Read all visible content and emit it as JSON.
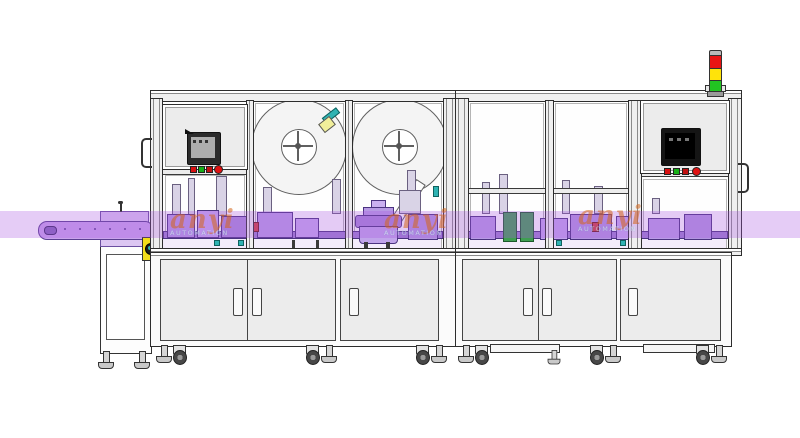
{
  "scene": {
    "description": "CAD line drawing of an automated assembly and labeling machine line with two framed enclosures, left infeed conveyor, two label reels, two HMI panels and a signal tower",
    "background": "#ffffff"
  },
  "colors": {
    "highlight_band": "#a855e0",
    "machinery_purple": "#b296e0",
    "conveyor_purple": "#c9a4ec",
    "frame_line": "#2d2d2d",
    "cabinet_panel": "#ececec",
    "drive_guard_yellow": "#f2dd1b",
    "accent_teal": "#2fb3b3",
    "accent_green": "#3f9e52"
  },
  "tower_light": {
    "segments": [
      {
        "state": "red",
        "color": "#e81414"
      },
      {
        "state": "yellow",
        "color": "#ffe30a"
      },
      {
        "state": "green",
        "color": "#22c422"
      }
    ]
  },
  "hmi_left": {
    "screen": "grey-lcd",
    "buttons": [
      "#d81111",
      "#17b017",
      "#c01010",
      "#e01212"
    ]
  },
  "hmi_right": {
    "screen": "black-lcd",
    "buttons": [
      "#d81111",
      "#17b017",
      "#c01010",
      "#e01212"
    ]
  },
  "watermark": {
    "brand": "anyi",
    "caption": "AUTOMATION"
  }
}
